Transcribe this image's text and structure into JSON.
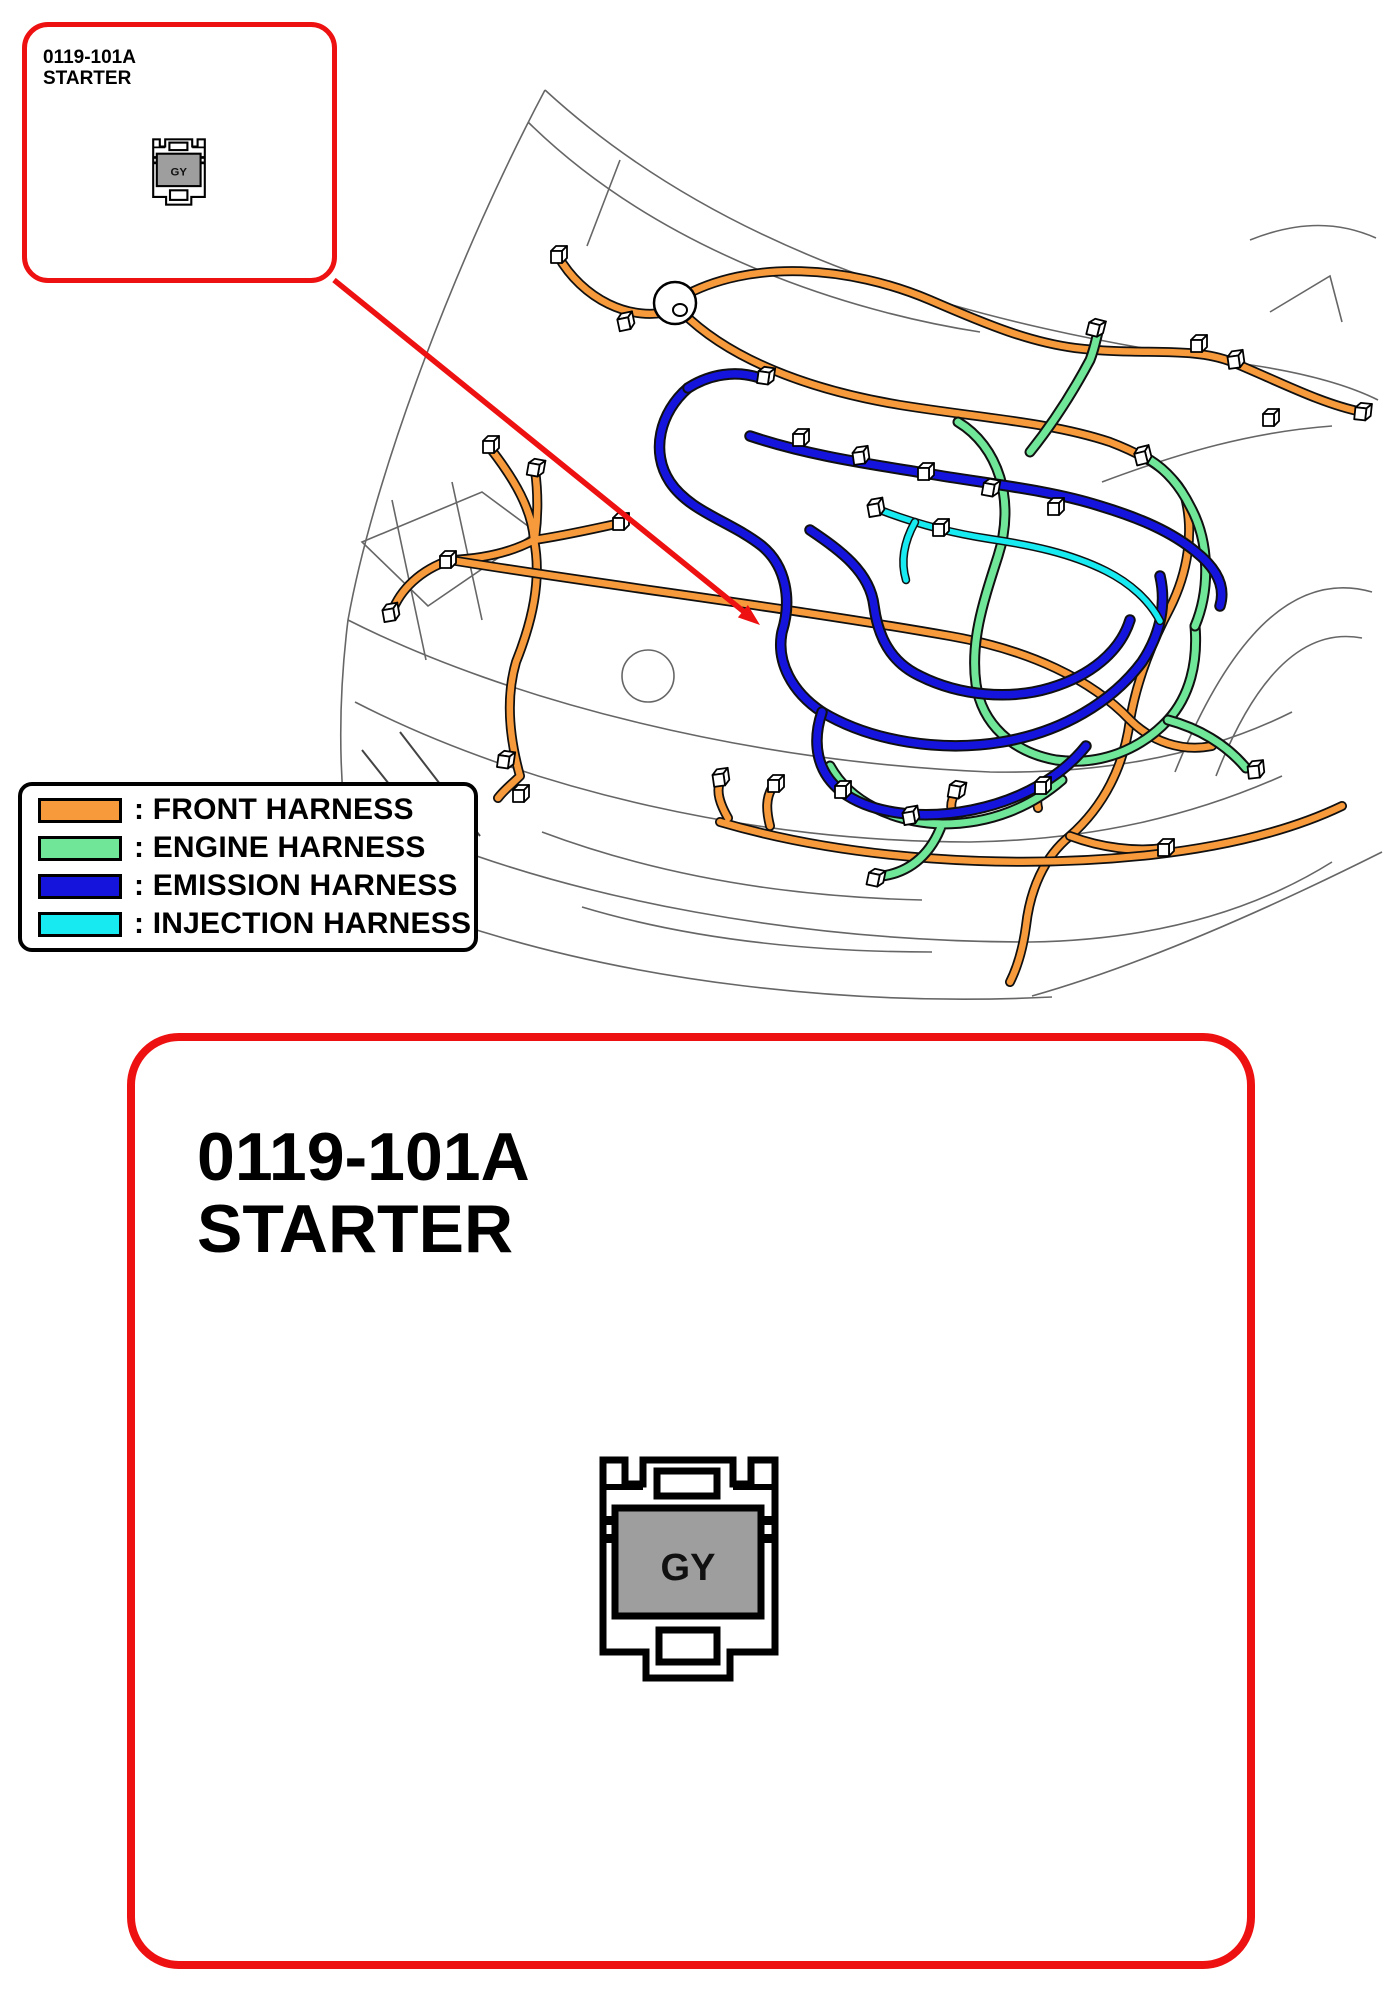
{
  "colors": {
    "accent_red": "#EE1111",
    "front_harness": "#F79A3B",
    "engine_harness": "#70E699",
    "emission_harness": "#1414DC",
    "injection_harness": "#18EAF2",
    "connector_face": "#9E9E9E"
  },
  "callout": {
    "code": "0119-101A",
    "name": "STARTER"
  },
  "detail": {
    "code": "0119-101A",
    "name": "STARTER"
  },
  "connector": {
    "code": "GY"
  },
  "legend": {
    "items": [
      {
        "text": ": FRONT HARNESS",
        "color": "#F79A3B"
      },
      {
        "text": ": ENGINE HARNESS",
        "color": "#70E699"
      },
      {
        "text": ": EMISSION HARNESS",
        "color": "#1414DC"
      },
      {
        "text": ": INJECTION HARNESS",
        "color": "#18EAF2"
      }
    ]
  }
}
